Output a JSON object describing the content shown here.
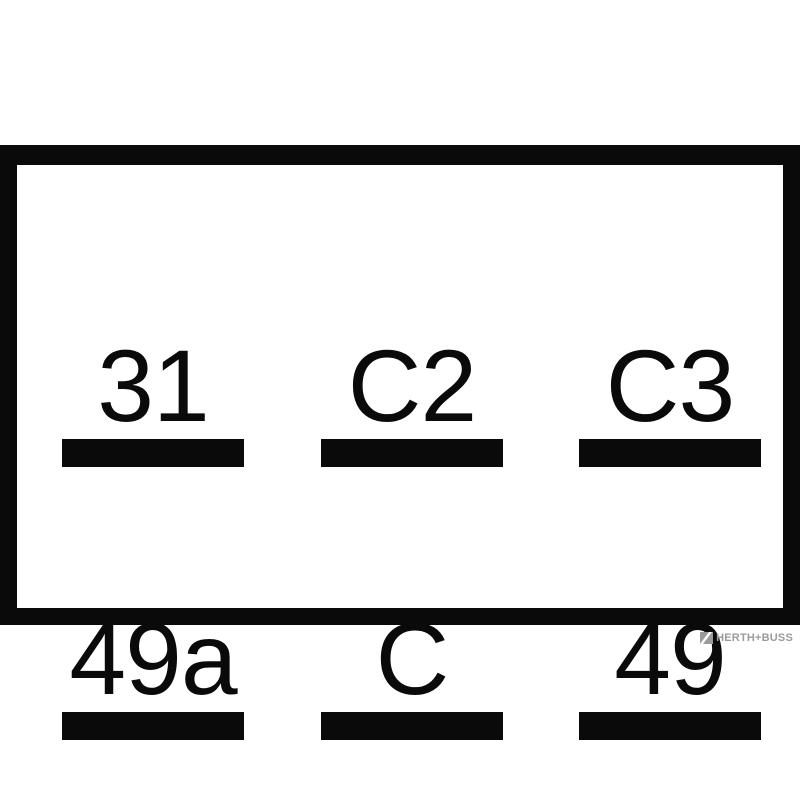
{
  "diagram": {
    "kind": "relay-terminal-pinout",
    "rows": 2,
    "columns": 3
  },
  "terminals": [
    {
      "label": "31",
      "row": 0,
      "col": 0
    },
    {
      "label": "C2",
      "row": 0,
      "col": 1
    },
    {
      "label": "C3",
      "row": 0,
      "col": 2
    },
    {
      "label": "49a",
      "row": 1,
      "col": 0
    },
    {
      "label": "C",
      "row": 1,
      "col": 1
    },
    {
      "label": "49",
      "row": 1,
      "col": 2
    }
  ],
  "branding": {
    "logo_text": "HERTH+BUSS",
    "logo_icon": "herth-buss-striped-square-icon"
  },
  "colors": {
    "ink": "#0a0a0a",
    "background": "#ffffff",
    "logo_gray": "#9b9b9b"
  }
}
